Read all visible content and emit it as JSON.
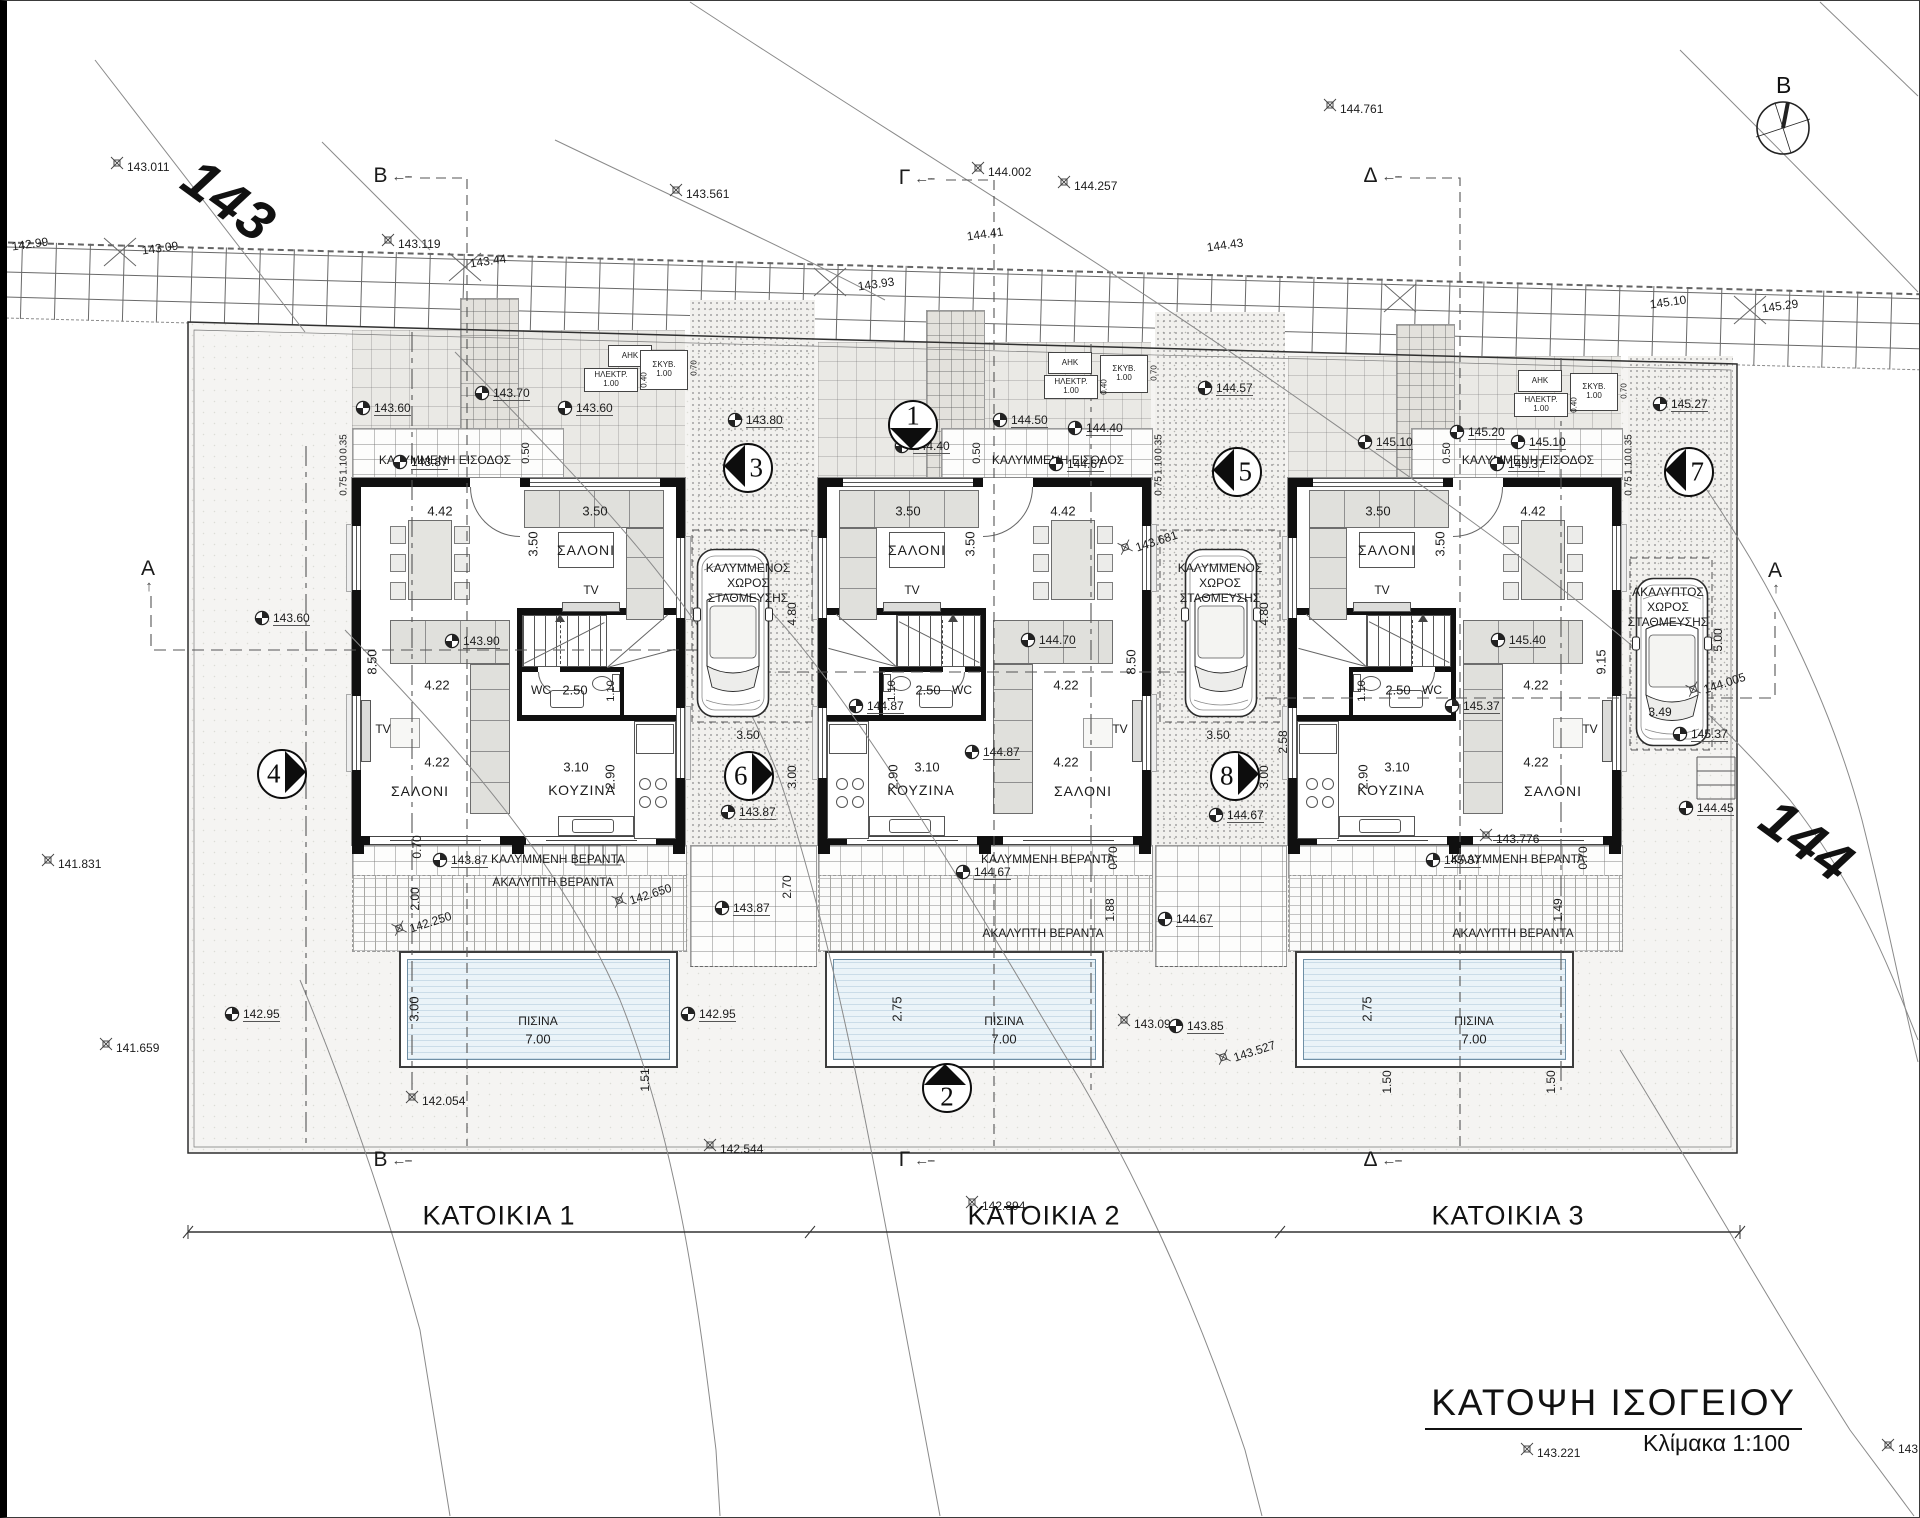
{
  "title": {
    "heading": "ΚΑΤΟΨΗ ΙΣΟΓΕΙΟΥ",
    "scale": "Κλίμακα 1:100"
  },
  "compass": {
    "label": "B"
  },
  "contour_labels": {
    "c143": "143",
    "c144": "144"
  },
  "axis": {
    "houses": [
      "ΚΑΤΟΙΚΙΑ 1",
      "ΚΑΤΟΙΚΙΑ 2",
      "ΚΑΤΟΙΚΙΑ 3"
    ]
  },
  "utilities": {
    "ahk": "ΑΗΚ",
    "elektr": "ΗΛΕΚΤΡ.",
    "skyv": "ΣΚΥΒ.",
    "one": "1.00",
    "d070": "0.70",
    "d040": "0.40"
  },
  "parking": [
    {
      "lines": [
        "ΚΑΛΥΜΜΕΝΟΣ",
        "ΧΩΡΟΣ",
        "ΣΤΑΘΜΕΥΣΗΣ"
      ]
    },
    {
      "lines": [
        "ΚΑΛΥΜΜΕΝΟΣ",
        "ΧΩΡΟΣ",
        "ΣΤΑΘΜΕΥΣΗΣ"
      ]
    },
    {
      "lines": [
        "ΑΚΑΛΥΠΤΟΣ",
        "ΧΩΡΟΣ",
        "ΣΤΑΘΜΕΥΣΗΣ"
      ]
    }
  ],
  "section_letters": [
    {
      "t": "B",
      "x": 392,
      "y": 176,
      "arrow": "left"
    },
    {
      "t": "Γ",
      "x": 916,
      "y": 178,
      "arrow": "left"
    },
    {
      "t": "Δ",
      "x": 1382,
      "y": 176,
      "arrow": "left"
    },
    {
      "t": "B",
      "x": 392,
      "y": 1160,
      "arrow": "left"
    },
    {
      "t": "Γ",
      "x": 916,
      "y": 1160,
      "arrow": "left"
    },
    {
      "t": "Δ",
      "x": 1382,
      "y": 1160,
      "arrow": "left"
    },
    {
      "t": "A",
      "x": 148,
      "y": 576,
      "arrow": "up"
    },
    {
      "t": "A",
      "x": 1775,
      "y": 578,
      "arrow": "up"
    }
  ],
  "section_circles": [
    {
      "n": "1",
      "x": 913,
      "y": 425,
      "dir": "down"
    },
    {
      "n": "2",
      "x": 947,
      "y": 1088,
      "dir": "up"
    },
    {
      "n": "3",
      "x": 748,
      "y": 468,
      "dir": "left"
    },
    {
      "n": "4",
      "x": 282,
      "y": 774,
      "dir": "right"
    },
    {
      "n": "5",
      "x": 1237,
      "y": 472,
      "dir": "left"
    },
    {
      "n": "6",
      "x": 749,
      "y": 776,
      "dir": "right"
    },
    {
      "n": "7",
      "x": 1689,
      "y": 472,
      "dir": "left"
    },
    {
      "n": "8",
      "x": 1235,
      "y": 776,
      "dir": "right"
    }
  ],
  "houses": [
    {
      "name": "ΚΑΤΟΙΚΙΑ 1",
      "entrance": "ΚΑΛΥΜΜΕΝΗ ΕΙΣΟΔΟΣ",
      "covered_veranda": "ΚΑΛΥΜΜΕΝΗ ΒΕΡΑΝΤΑ",
      "open_veranda": "ΑΚΑΛΥΠΤΗ ΒΕΡΑΝΤΑ",
      "pool": "ΠΙΣΙΝΑ",
      "lounge": "ΣΑΛΟΝΙ",
      "living": "ΣΑΛΟΝΙ",
      "kitchen": "ΚΟΥΖΙΝΑ",
      "wc": "WC",
      "tv": "TV",
      "dims": {
        "dining": "4.42",
        "lounge_w": "3.50",
        "lounge_h": "3.50",
        "top_off": "0.50",
        "living_a": "4.22",
        "living_b": "4.22",
        "kitchen_w": "3.10",
        "kitchen_h": "2.90",
        "wc_w": "2.50",
        "wc_h": "1.10",
        "side": "8.50",
        "entr": [
          "0.35",
          "1.10",
          "0.75"
        ],
        "pool_w": "7.00",
        "pool_h": "3.00"
      },
      "elevs": {
        "court": [
          "143.60",
          "143.70",
          "143.60"
        ],
        "entrance": "143.87",
        "interior": "143.90",
        "veranda": "143.87"
      }
    },
    {
      "name": "ΚΑΤΟΙΚΙΑ 2",
      "entrance": "ΚΑΛΥΜΜΕΝΗ ΕΙΣΟΔΟΣ",
      "covered_veranda": "ΚΑΛΥΜΜΕΝΗ ΒΕΡΑΝΤΑ",
      "open_veranda": "ΑΚΑΛΥΠΤΗ ΒΕΡΑΝΤΑ",
      "pool": "ΠΙΣΙΝΑ",
      "lounge": "ΣΑΛΟΝΙ",
      "living": "ΣΑΛΟΝΙ",
      "kitchen": "ΚΟΥΖΙΝΑ",
      "wc": "WC",
      "tv": "TV",
      "dims": {
        "dining": "4.42",
        "lounge_w": "3.50",
        "lounge_h": "3.50",
        "top_off": "0.50",
        "living_a": "4.22",
        "living_b": "4.22",
        "kitchen_w": "3.10",
        "kitchen_h": "2.90",
        "wc_w": "2.50",
        "wc_h": "1.10",
        "side": "8.50",
        "entr": [
          "0.35",
          "1.10",
          "0.75"
        ],
        "pool_w": "7.00",
        "pool_h": "2.75"
      },
      "elevs": {
        "court": [
          "144.40",
          "144.50",
          "144.40"
        ],
        "entrance": "144.67",
        "interior": "144.70",
        "veranda": "144.67"
      }
    },
    {
      "name": "ΚΑΤΟΙΚΙΑ 3",
      "entrance": "ΚΑΛΥΜΜΕΝΗ ΕΙΣΟΔΟΣ",
      "covered_veranda": "ΚΑΛΥΜΜΕΝΗ ΒΕΡΑΝΤΑ",
      "open_veranda": "ΑΚΑΛΥΠΤΗ ΒΕΡΑΝΤΑ",
      "pool": "ΠΙΣΙΝΑ",
      "lounge": "ΣΑΛΟΝΙ",
      "living": "ΣΑΛΟΝΙ",
      "kitchen": "ΚΟΥΖΙΝΑ",
      "wc": "WC",
      "tv": "TV",
      "dims": {
        "dining": "4.42",
        "lounge_w": "3.50",
        "lounge_h": "3.50",
        "top_off": "0.50",
        "living_a": "4.22",
        "living_b": "4.22",
        "kitchen_w": "3.10",
        "kitchen_h": "2.90",
        "wc_w": "2.50",
        "wc_h": "1.10",
        "side": "9.15",
        "entr": [
          "0.35",
          "1.10",
          "0.75"
        ],
        "pool_w": "7.00",
        "pool_h": "2.75"
      },
      "elevs": {
        "court": [
          "145.10",
          "145.20",
          "145.10"
        ],
        "entrance": "145.37",
        "interior": "145.40",
        "veranda": "145.37"
      }
    }
  ],
  "annotations": [
    {
      "t": "143.011",
      "type": "x",
      "x": 117,
      "y": 163
    },
    {
      "t": "142.99",
      "type": "t",
      "x": 30,
      "y": 244,
      "rot": -8
    },
    {
      "t": "143.09",
      "type": "t",
      "x": 160,
      "y": 248,
      "rot": -8
    },
    {
      "t": "143.119",
      "type": "x",
      "x": 388,
      "y": 240
    },
    {
      "t": "143.44",
      "type": "t",
      "x": 488,
      "y": 261,
      "rot": -8
    },
    {
      "t": "143.561",
      "type": "x",
      "x": 676,
      "y": 190
    },
    {
      "t": "143.93",
      "type": "t",
      "x": 876,
      "y": 284,
      "rot": -8
    },
    {
      "t": "144.002",
      "type": "x",
      "x": 978,
      "y": 168
    },
    {
      "t": "144.41",
      "type": "t",
      "x": 985,
      "y": 234,
      "rot": -8
    },
    {
      "t": "144.257",
      "type": "x",
      "x": 1064,
      "y": 182
    },
    {
      "t": "144.761",
      "type": "x",
      "x": 1330,
      "y": 105
    },
    {
      "t": "144.43",
      "type": "t",
      "x": 1225,
      "y": 245,
      "rot": -8
    },
    {
      "t": "145.10",
      "type": "t",
      "x": 1668,
      "y": 302,
      "rot": -8
    },
    {
      "t": "145.29",
      "type": "t",
      "x": 1780,
      "y": 306,
      "rot": -8
    },
    {
      "t": "141.831",
      "type": "x",
      "x": 48,
      "y": 860
    },
    {
      "t": "143.60",
      "type": "q",
      "x": 262,
      "y": 618
    },
    {
      "t": "142.95",
      "type": "q",
      "x": 232,
      "y": 1014
    },
    {
      "t": "142.95",
      "type": "q",
      "x": 688,
      "y": 1014
    },
    {
      "t": "141.659",
      "type": "x",
      "x": 106,
      "y": 1044
    },
    {
      "t": "142.054",
      "type": "x",
      "x": 412,
      "y": 1097
    },
    {
      "t": "142.544",
      "type": "x",
      "x": 710,
      "y": 1145
    },
    {
      "t": "142.894",
      "type": "x",
      "x": 972,
      "y": 1202
    },
    {
      "t": "143.221",
      "type": "x",
      "x": 1527,
      "y": 1449
    },
    {
      "t": "143.6",
      "type": "x",
      "x": 1888,
      "y": 1445
    },
    {
      "t": "143.776",
      "type": "x",
      "x": 1486,
      "y": 835
    },
    {
      "t": "142.650",
      "type": "x",
      "x": 618,
      "y": 893,
      "rot": -18
    },
    {
      "t": "142.250",
      "type": "x",
      "x": 398,
      "y": 921,
      "rot": -18
    },
    {
      "t": "143.80",
      "type": "q",
      "x": 735,
      "y": 420
    },
    {
      "t": "3.50",
      "type": "t",
      "x": 748,
      "y": 735
    },
    {
      "t": "4.80",
      "type": "t",
      "x": 792,
      "y": 614,
      "rot": -90
    },
    {
      "t": "3.00",
      "type": "t",
      "x": 792,
      "y": 777,
      "rot": -90
    },
    {
      "t": "143.87",
      "type": "q",
      "x": 728,
      "y": 812
    },
    {
      "t": "143.87",
      "type": "q",
      "x": 722,
      "y": 908
    },
    {
      "t": "2.70",
      "type": "t",
      "x": 787,
      "y": 887,
      "rot": -90
    },
    {
      "t": "144.57",
      "type": "q",
      "x": 1205,
      "y": 388
    },
    {
      "t": "3.50",
      "type": "t",
      "x": 1218,
      "y": 735
    },
    {
      "t": "4.80",
      "type": "t",
      "x": 1264,
      "y": 614,
      "rot": -90
    },
    {
      "t": "3.00",
      "type": "t",
      "x": 1264,
      "y": 777,
      "rot": -90
    },
    {
      "t": "144.67",
      "type": "q",
      "x": 1216,
      "y": 815
    },
    {
      "t": "144.67",
      "type": "q",
      "x": 1165,
      "y": 919
    },
    {
      "t": "2.58",
      "type": "t",
      "x": 1283,
      "y": 742,
      "rot": -90
    },
    {
      "t": "143.681",
      "type": "x",
      "x": 1124,
      "y": 540,
      "rot": -18
    },
    {
      "t": "143.092",
      "type": "x",
      "x": 1124,
      "y": 1020
    },
    {
      "t": "143.85",
      "type": "q",
      "x": 1176,
      "y": 1026
    },
    {
      "t": "143.527",
      "type": "x",
      "x": 1222,
      "y": 1050,
      "rot": -18
    },
    {
      "t": "145.27",
      "type": "q",
      "x": 1660,
      "y": 404
    },
    {
      "t": "3.49",
      "type": "t",
      "x": 1660,
      "y": 712
    },
    {
      "t": "5.00",
      "type": "t",
      "x": 1718,
      "y": 640,
      "rot": -90
    },
    {
      "t": "145.37",
      "type": "q",
      "x": 1680,
      "y": 734
    },
    {
      "t": "144.45",
      "type": "q",
      "x": 1686,
      "y": 808
    },
    {
      "t": "144.005",
      "type": "x",
      "x": 1692,
      "y": 682,
      "rot": -18
    },
    {
      "t": "144.87",
      "type": "q",
      "x": 856,
      "y": 706
    },
    {
      "t": "144.87",
      "type": "q",
      "x": 972,
      "y": 752
    },
    {
      "t": "145.37",
      "type": "q",
      "x": 1452,
      "y": 706
    },
    {
      "t": "1.51",
      "type": "t",
      "x": 645,
      "y": 1080,
      "rot": -90
    },
    {
      "t": "1.50",
      "type": "t",
      "x": 1387,
      "y": 1082,
      "rot": -90
    },
    {
      "t": "1.50",
      "type": "t",
      "x": 1551,
      "y": 1082,
      "rot": -90
    },
    {
      "t": "1.88",
      "type": "t",
      "x": 1110,
      "y": 910,
      "rot": -90
    },
    {
      "t": "1.49",
      "type": "t",
      "x": 1558,
      "y": 910,
      "rot": -90
    },
    {
      "t": "2.00",
      "type": "t",
      "x": 415,
      "y": 899,
      "rot": -90
    },
    {
      "t": "0.70",
      "type": "t",
      "x": 417,
      "y": 847,
      "rot": -90
    },
    {
      "t": "0.70",
      "type": "t",
      "x": 1113,
      "y": 858,
      "rot": -90
    },
    {
      "t": "0.70",
      "type": "t",
      "x": 1583,
      "y": 858,
      "rot": -90
    }
  ]
}
